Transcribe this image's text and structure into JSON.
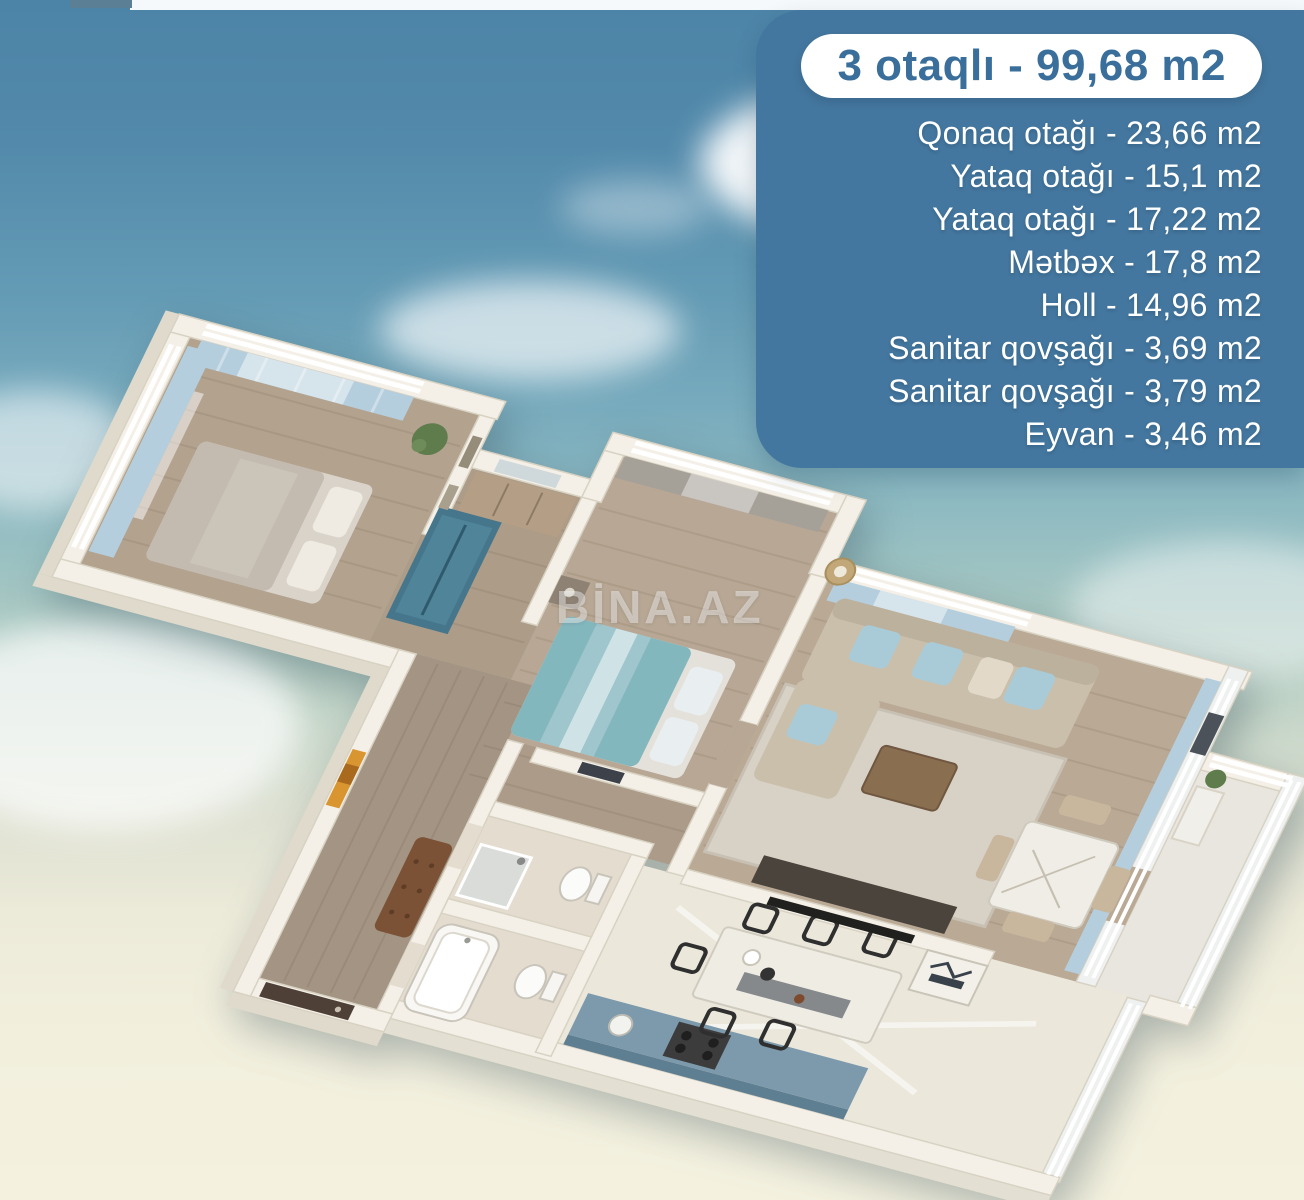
{
  "panel": {
    "title": "3 otaqlı - 99,68 m2",
    "rooms": [
      {
        "label": "Qonaq otağı",
        "area": "23,66 m2",
        "display": "Qonaq otağı - 23,66 m2"
      },
      {
        "label": "Yataq otağı",
        "area": "15,1 m2",
        "display": "Yataq otağı - 15,1 m2"
      },
      {
        "label": "Yataq otağı",
        "area": "17,22 m2",
        "display": "Yataq otağı - 17,22 m2"
      },
      {
        "label": "Mətbəx",
        "area": "17,8 m2",
        "display": "Mətbəx - 17,8 m2"
      },
      {
        "label": "Holl",
        "area": "14,96 m2",
        "display": "Holl - 14,96 m2"
      },
      {
        "label": "Sanitar qovşağı",
        "area": "3,69 m2",
        "display": "Sanitar qovşağı - 3,69 m2"
      },
      {
        "label": "Sanitar qovşağı",
        "area": "3,79 m2",
        "display": "Sanitar qovşağı - 3,79 m2"
      },
      {
        "label": "Eyvan",
        "area": "3,46 m2",
        "display": "Eyvan - 3,46 m2"
      }
    ],
    "colors": {
      "background": "#44779F",
      "title_text": "#3A6F9B",
      "list_text": "#FFFFFF"
    }
  },
  "watermark": {
    "text": "BİNA.AZ"
  },
  "floor_plan": {
    "type": "3d-isometric-floor-plan",
    "total": "99,68 m2",
    "room_count_label": "3 otaqlı",
    "rooms_shown": [
      "bedroom-1",
      "bedroom-2",
      "living-room",
      "kitchen-dining",
      "hall",
      "bathroom-1",
      "bathroom-2",
      "balcony"
    ],
    "palette": {
      "walls": "#F4F0E7",
      "wood_floor": "#B2A28E",
      "marble_floor": "#EBE7DB",
      "wardrobe_teal": "#46768B",
      "curtain_blue": "#B5CEDD",
      "curtain_gray": "#A5A098",
      "sofa_beige": "#CABFAB",
      "bed2_teal": "#83B7BE",
      "bench_brown": "#7B5236",
      "sky_top": "#4C84A7",
      "ground_cream": "#F4F1DF"
    }
  }
}
